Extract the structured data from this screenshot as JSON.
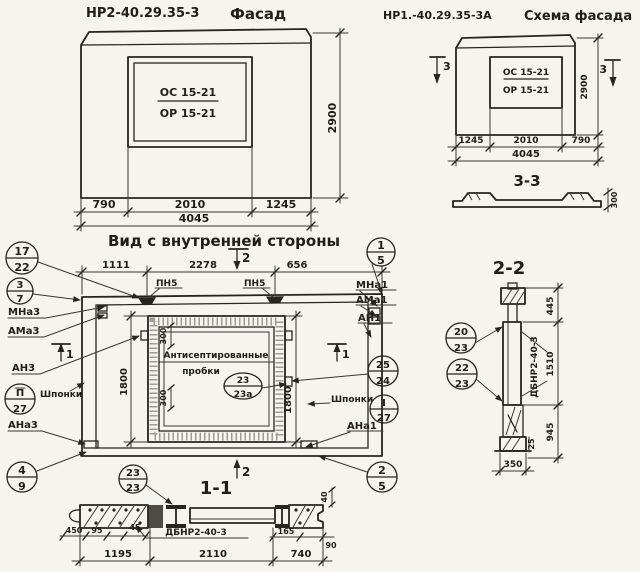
{
  "facade": {
    "code": "НР2-40.29.35-3",
    "title": "Фасад",
    "window_mark_top": "ОС 15-21",
    "window_mark_bottom": "ОР 15-21",
    "dim_height": "2900",
    "dim_left": "790",
    "dim_mid": "2010",
    "dim_right": "1245",
    "dim_total": "4045"
  },
  "scheme": {
    "code": "НР1.-40.29.35-3А",
    "title": "Схема фасада",
    "window_mark_top": "ОС 15-21",
    "window_mark_bottom": "ОР 15-21",
    "dim_height": "2900",
    "section_mark": "3",
    "dim_left": "1245",
    "dim_mid": "2010",
    "dim_right": "790",
    "dim_total": "4045",
    "section_title": "3-3",
    "section_dim": "300"
  },
  "inner": {
    "title": "Вид с внутренней стороны",
    "dim_top_1": "1111",
    "dim_top_2": "2278",
    "dim_top_3": "656",
    "weld_1": "ПН5",
    "weld_2": "ПН5",
    "sec2": "2",
    "sec1_left": "1",
    "sec1_right": "1",
    "dim_h_left": "1800",
    "dim_h_right": "1800",
    "dim_plug_1": "300",
    "dim_plug_2": "300",
    "note_1": "Антисептированные",
    "note_2": "пробки",
    "lbl_mna3": "МНа3",
    "lbl_ama3": "АМа3",
    "lbl_an3": "АН3",
    "lbl_shponki_left": "Шпонки",
    "lbl_ana3": "АНа3",
    "lbl_mna1": "МНа1",
    "lbl_ama1": "АМа1",
    "lbl_an1": "АН1",
    "lbl_shponki_right": "Шпонки",
    "lbl_ana1": "АНа1"
  },
  "callouts": {
    "k17_22": {
      "top": "17",
      "bot": "22"
    },
    "k3_7": {
      "top": "3",
      "bot": "7"
    },
    "kII_27": {
      "top": "П",
      "bot": "27"
    },
    "k4_9": {
      "top": "4",
      "bot": "9"
    },
    "k23_23": {
      "top": "23",
      "bot": "23"
    },
    "k1_5": {
      "top": "1",
      "bot": "5"
    },
    "k25_24": {
      "top": "25",
      "bot": "24"
    },
    "kI_27": {
      "top": "I",
      "bot": "27"
    },
    "k2_5": {
      "top": "2",
      "bot": "5"
    },
    "k23_23a": {
      "top": "23",
      "bot": "23а"
    },
    "k20_23": {
      "top": "20",
      "bot": "23"
    },
    "k22_23": {
      "top": "22",
      "bot": "23"
    }
  },
  "sec11": {
    "title": "1-1",
    "beam": "ДБНР2-40-3",
    "d450": "450",
    "d95": "95",
    "d45": "45",
    "d1195": "1195",
    "d2110": "2110",
    "d740": "740",
    "d165": "165",
    "d90": "90",
    "d40": "40"
  },
  "sec22": {
    "title": "2-2",
    "beam": "ДБНР2-40-3",
    "d445": "445",
    "d1510": "1510",
    "d945": "945",
    "d25": "25",
    "d350": "350"
  }
}
